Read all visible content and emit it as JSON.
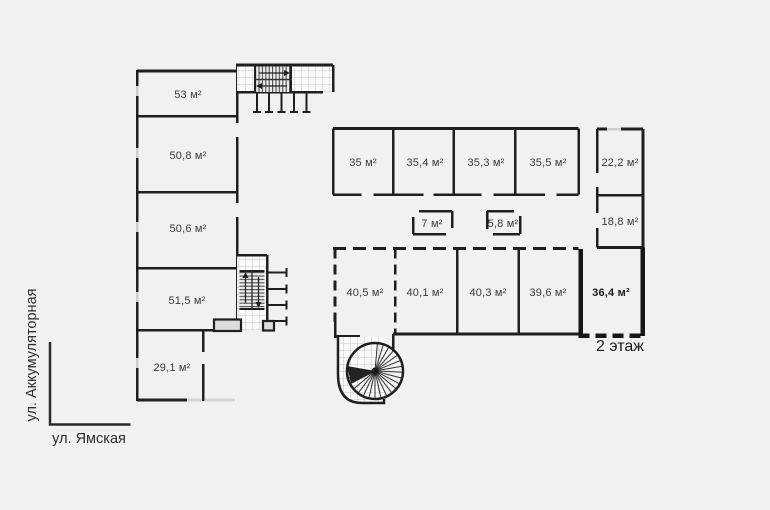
{
  "floor_label": "2 этаж",
  "streets": {
    "vertical_label": "ул. Аккумуляторная",
    "horizontal_label": "ул. Ямская"
  },
  "rooms": {
    "left_wing": [
      "53 м²",
      "50,8 м²",
      "50,6 м²",
      "51,5 м²",
      "29,1 м²"
    ],
    "middle_row": [
      "35 м²",
      "35,4 м²",
      "35,3 м²",
      "35,5 м²"
    ],
    "right_column": [
      "22,2 м²",
      "18,8 м²"
    ],
    "corridor_rooms": [
      "7 м²",
      "5,8 м²"
    ],
    "bottom_row": [
      "40,5 м²",
      "40,1 м²",
      "40,3 м²",
      "39,6 м²"
    ],
    "highlighted_room": "36,4 м²"
  },
  "colors": {
    "background": "#f1f1f1",
    "wall": "#1f1f1f",
    "text": "#3a3a3a",
    "window_line": "#cfcfcf",
    "hatch_line": "#c6c6c6",
    "hatch_fill": "#fafafa",
    "stair_fill": "#dcdcdc",
    "street": "#2a2a2a"
  }
}
